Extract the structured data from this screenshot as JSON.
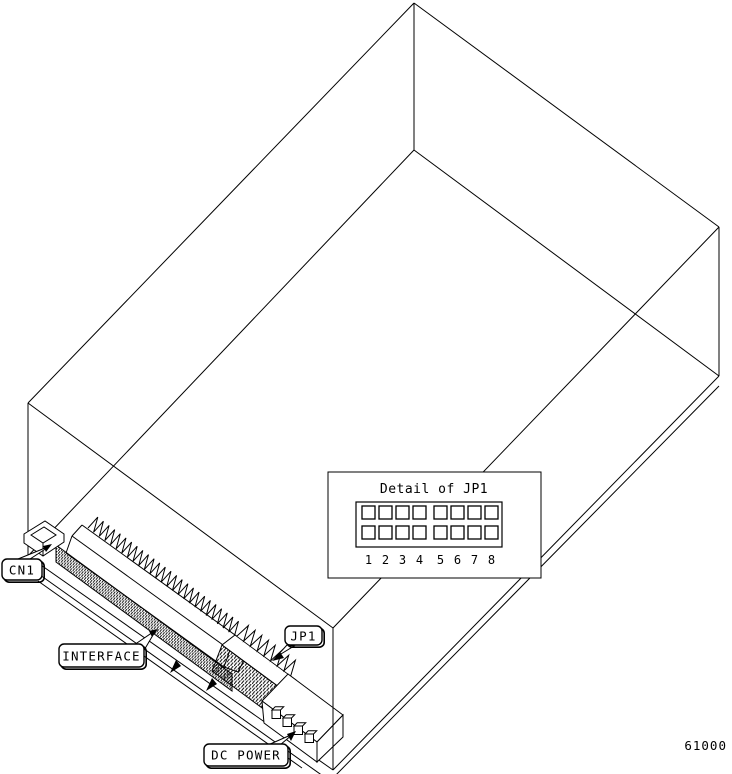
{
  "figure_number": "61000",
  "callouts": {
    "cn1": "CN1",
    "interface": "INTERFACE",
    "jp1": "JP1",
    "dc_power": "DC POWER"
  },
  "detail_box": {
    "title": "Detail of JP1",
    "rows": 2,
    "cols": 8,
    "pin_numbers": [
      "1",
      "2",
      "3",
      "4",
      "5",
      "6",
      "7",
      "8"
    ]
  },
  "connectors_3d": {
    "interface_pin_teeth": 26,
    "jp1_teeth": 8,
    "dc_power_pins": 4
  },
  "colors": {
    "line": "#000000",
    "background": "#ffffff"
  }
}
